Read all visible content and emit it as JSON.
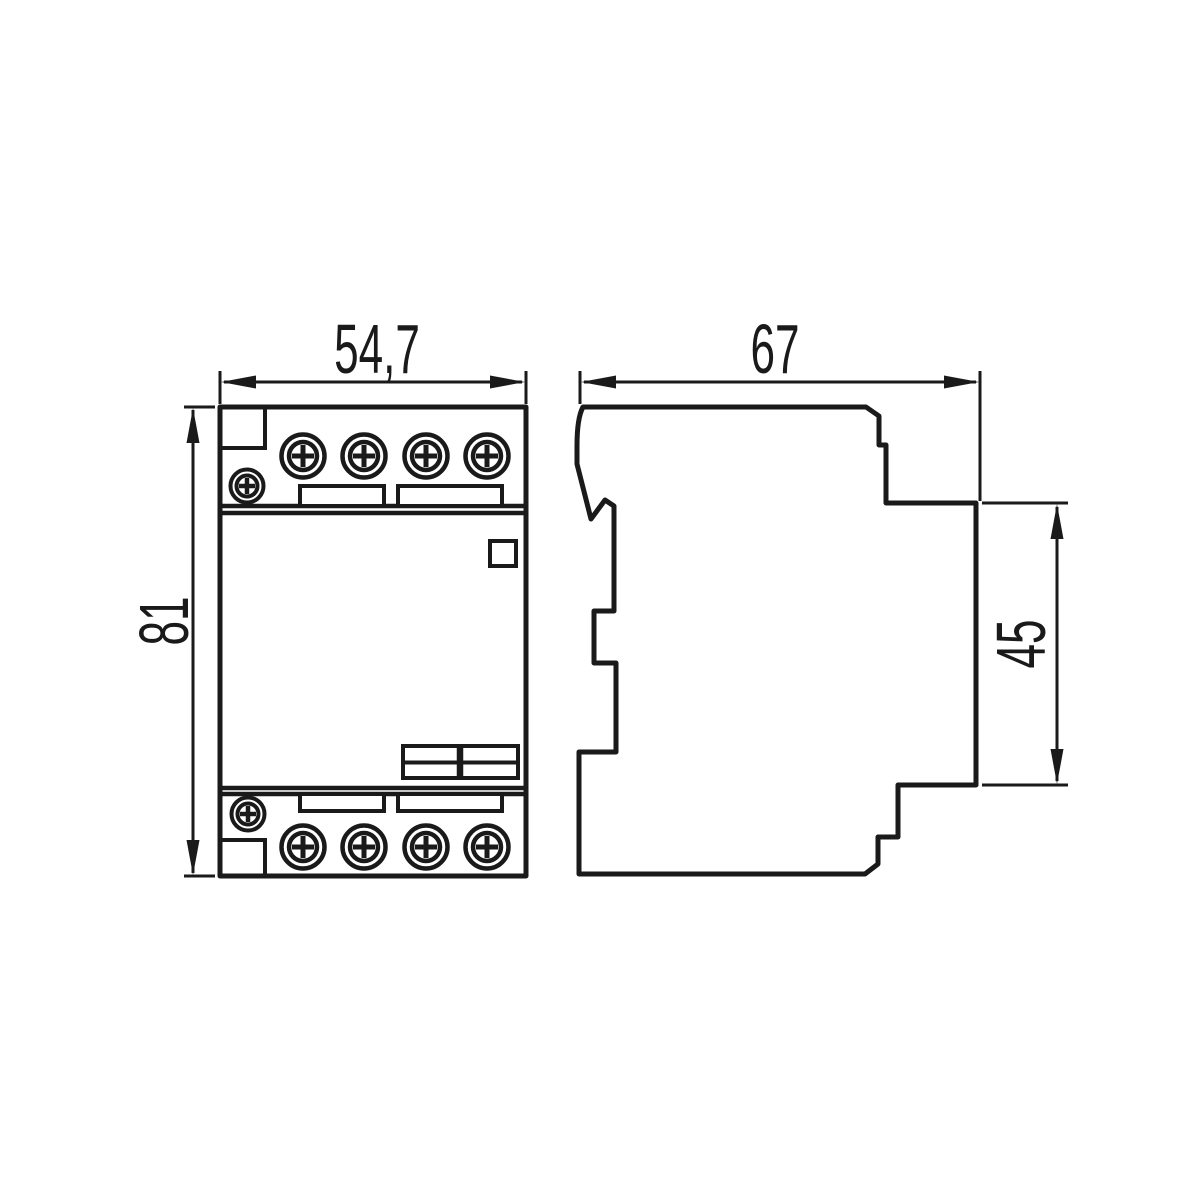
{
  "diagram": {
    "type": "technical-dimension-drawing",
    "views": {
      "front": {
        "width_label": "54,7",
        "height_label": "81"
      },
      "side": {
        "depth_label": "67",
        "rail_section_label": "45"
      }
    },
    "colors": {
      "line": "#1a1a1a",
      "background": "#ffffff"
    }
  }
}
